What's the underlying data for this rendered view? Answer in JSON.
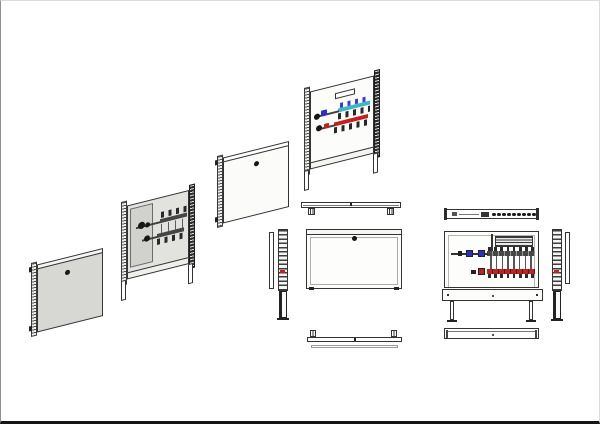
{
  "page": {
    "background": "#ffffff",
    "frame_line": "#8f8f8f",
    "bottom_edge": "#161616"
  },
  "colors": {
    "page_bg": "#ffffff",
    "frame_line": "#8f8f8f",
    "bottom_edge": "#161616",
    "line": "#2f2f2f",
    "door_gray": "#d7d7d4",
    "door_white": "#fbfbfa",
    "panel_light": "#e2e2df",
    "compartment_gray": "#d1d1ce",
    "metal_dark": "#454545",
    "flow_cyan": "#3db6c6",
    "meter_blue": "#3a3ae0",
    "valve_blue": "#2d2dcf",
    "return_red": "#c2221d"
  },
  "manifold": {
    "loop_count": 8,
    "cap_count": 8,
    "top_view_port_count": 9
  },
  "views": {
    "isometric": [
      "door-panel-gray",
      "cabinet-open-gray-manifold",
      "door-panel-white",
      "cabinet-open-colored-manifold"
    ],
    "orthographic": [
      "top-view-closed",
      "front-view-closed",
      "side-view-left",
      "bottom-view-closed",
      "top-view-open",
      "front-view-open",
      "side-view-right",
      "bottom-view-open"
    ]
  }
}
